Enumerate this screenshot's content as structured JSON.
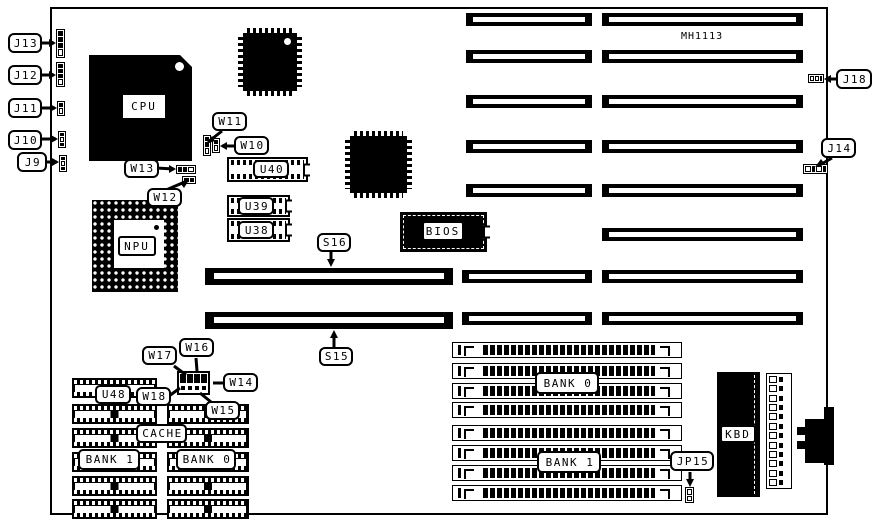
{
  "board": {
    "model_text": "MH1113"
  },
  "callouts": {
    "j9": "J9",
    "j10": "J10",
    "j11": "J11",
    "j12": "J12",
    "j13": "J13",
    "j14": "J14",
    "j18": "J18",
    "jp15": "JP15",
    "w10": "W10",
    "w11": "W11",
    "w12": "W12",
    "w13": "W13",
    "w14": "W14",
    "w15": "W15",
    "w16": "W16",
    "w17": "W17",
    "w18": "W18",
    "s15": "S15",
    "s16": "S16"
  },
  "chips": {
    "cpu": "CPU",
    "npu": "NPU",
    "bios": "BIOS",
    "kbd": "KBD",
    "u38": "U38",
    "u39": "U39",
    "u40": "U40",
    "u48": "U48"
  },
  "cache": {
    "label": "CACHE",
    "bank0": "BANK 0",
    "bank1": "BANK 1"
  },
  "simm": {
    "bank0": "BANK 0",
    "bank1": "BANK 1"
  },
  "structure": {
    "isa_slot_rows": 8,
    "simm_slots_total": 8,
    "cache_rows_left": 6,
    "cache_rows_right": 5,
    "power_connector_pins": 12
  }
}
